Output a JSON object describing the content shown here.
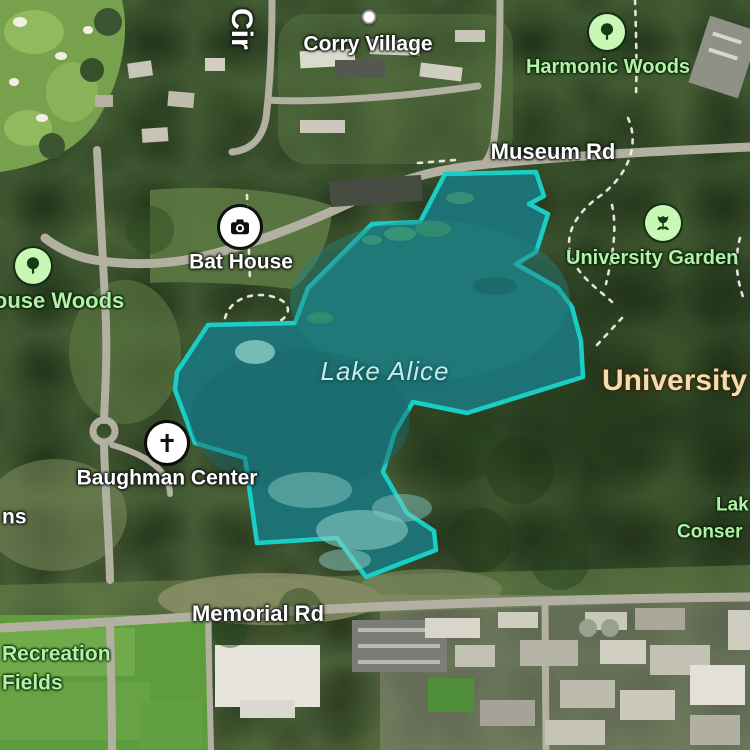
{
  "map_type": "satellite",
  "labels": {
    "street_cir": "Cir",
    "corry_village": "Corry Village",
    "harmonic_woods": "Harmonic Woods",
    "museum_rd": "Museum Rd",
    "bat_house": "Bat House",
    "university_garden": "University Garden",
    "house_woods": "House Woods",
    "lake_alice": "Lake Alice",
    "university": "University",
    "baughman_center": "Baughman Center",
    "left_edge_fragment": "ns",
    "lake_conservation_line1": "Lak",
    "lake_conservation_line2": "Conser",
    "memorial_rd": "Memorial Rd",
    "recreation_fields_line1": "Recreation",
    "recreation_fields_line2": "Fields"
  },
  "markers": {
    "corry_village": "poi-dot",
    "harmonic_woods": "tree-icon",
    "bat_house": "camera-icon",
    "university_garden": "flower-icon",
    "house_woods": "tree-icon",
    "baughman_center": "cross-icon"
  },
  "colors": {
    "lake_outline": "#19cfc5",
    "lake_fill": "#1c7275",
    "park_label": "#b5f0a8",
    "road_label": "#ffffff",
    "water_label": "#c6e9e9",
    "area_label": "#f2ddb0",
    "park_icon_bg": "#c9f7b5"
  }
}
